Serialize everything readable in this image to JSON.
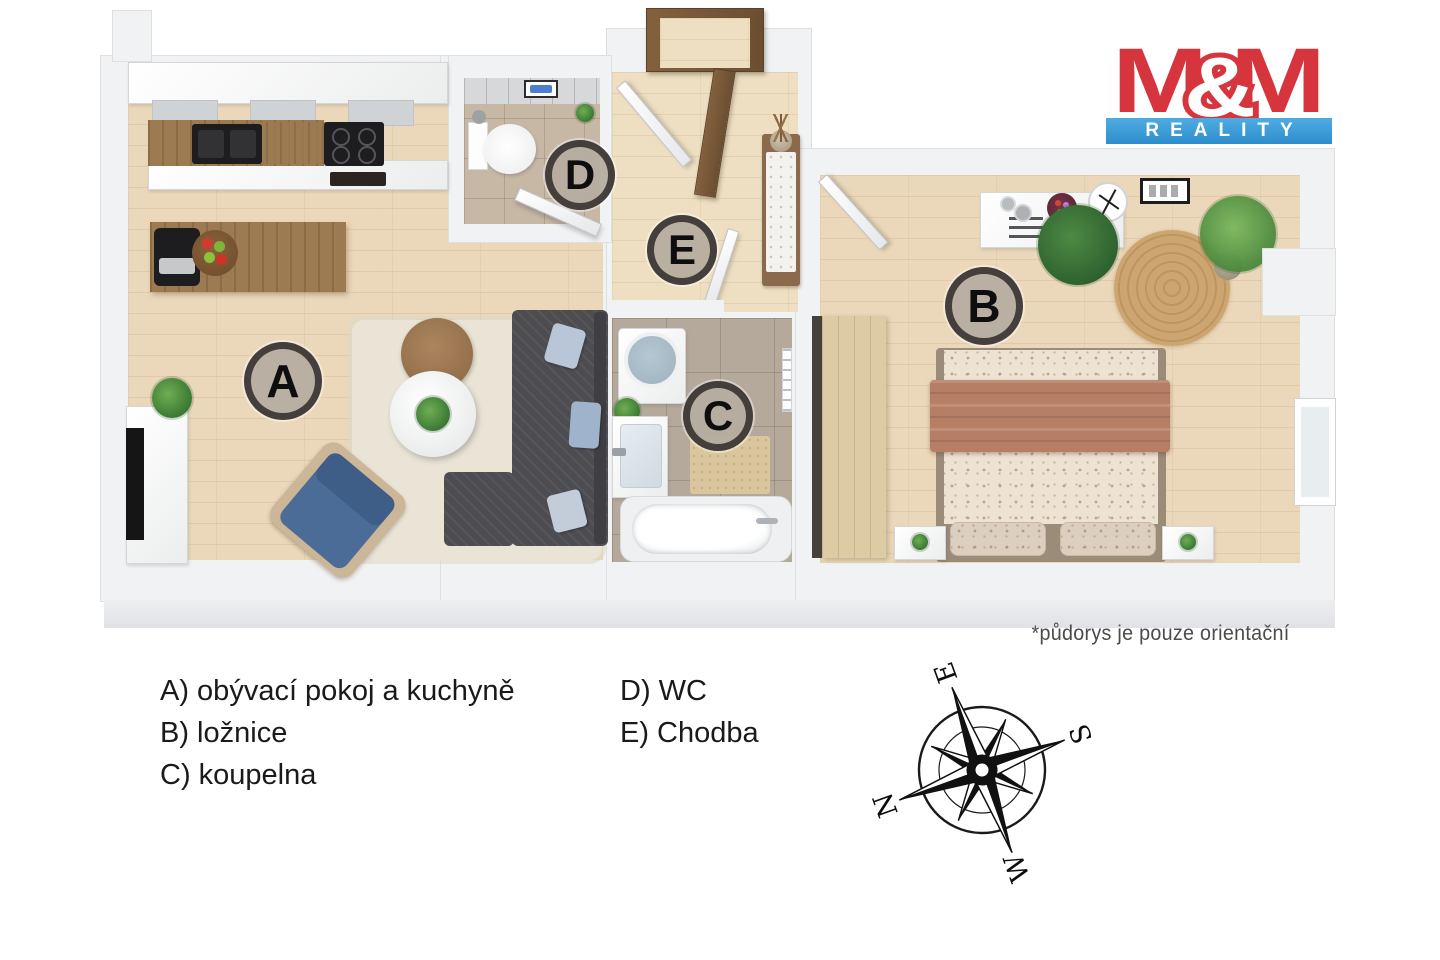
{
  "logo": {
    "m1": "M",
    "amp": "&",
    "m2": "M",
    "reality": "REALITY",
    "red": "#d7353d",
    "blue": "#3a9bdb"
  },
  "disclaimer": "*půdorys je pouze orientační",
  "legend": {
    "items": [
      "A) obývací pokoj a kuchyně",
      "B) ložnice",
      "C) koupelna",
      "D) WC",
      "E) Chodba"
    ]
  },
  "markers": {
    "a": "A",
    "b": "B",
    "c": "C",
    "d": "D",
    "e": "E"
  },
  "compass": {
    "north": "N",
    "east": "E",
    "south": "S",
    "west": "W"
  },
  "colors": {
    "floor_wood": "#ebd8ba",
    "tile_bath": "#b5a99b",
    "wall": "#f1f2f4",
    "marker_fill": "#b6ada0",
    "marker_ring": "#2f2c29",
    "sofa": "#4c4c51",
    "armchair_blue": "#4b6c97",
    "bed_blanket": "#b67e65"
  }
}
